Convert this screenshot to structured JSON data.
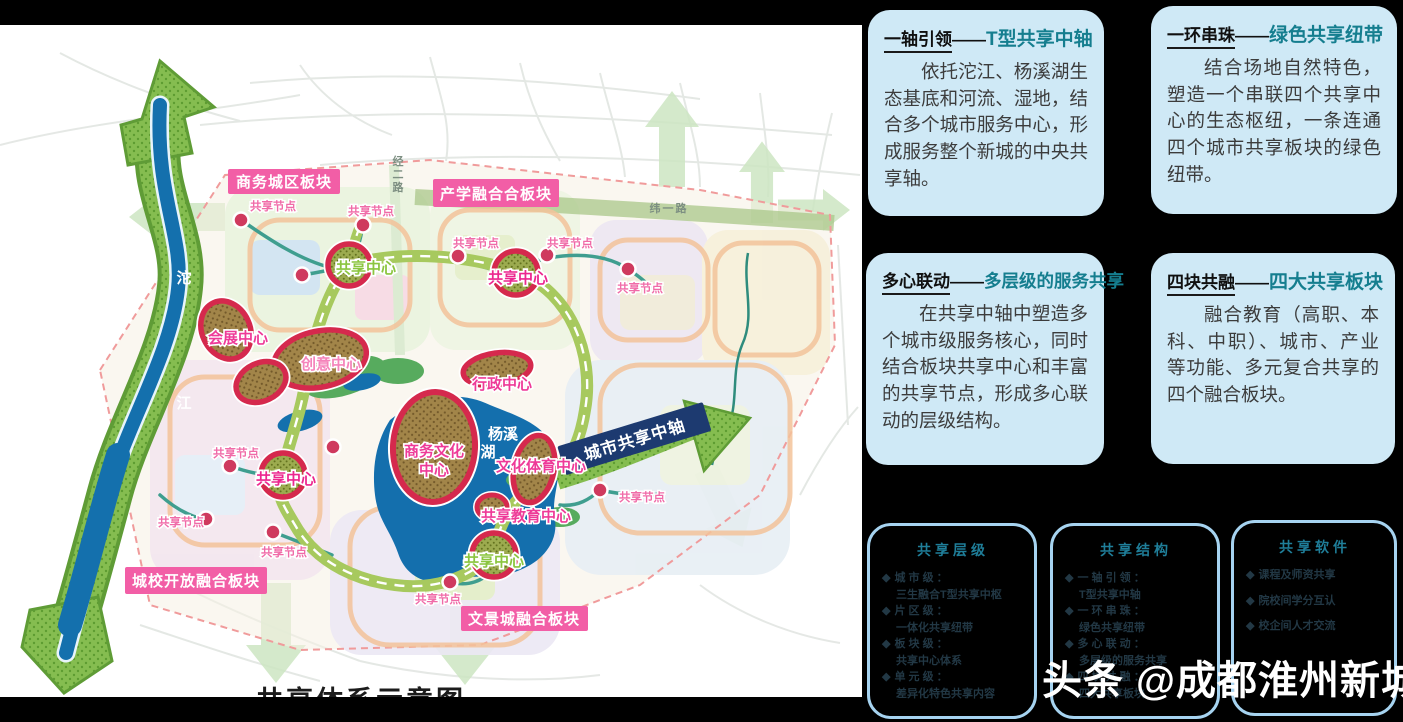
{
  "map": {
    "caption": "共享体系示意图",
    "river_label_top": "沱",
    "river_label_bottom": "江",
    "lake_label_line1": "杨溪",
    "lake_label_line2": "湖",
    "road_vertical": "经二路",
    "road_horizontal": "纬一路",
    "axis_label": "城市共享中轴",
    "node_label": "共享节点",
    "center_label": "共享中心",
    "blocks": {
      "business": "商务城区板块",
      "industry_edu": "产学融合合板块",
      "city_campus": "城校开放融合板块",
      "wenjing": "文景城融合板块"
    },
    "centers": {
      "exhibition": "会展中心",
      "creative": "创意中心",
      "admin": "行政中心",
      "biz_culture_line1": "商务文化",
      "biz_culture_line2": "中心",
      "culture_sports": "文化体育中心",
      "edu_share": "共享教育中心"
    }
  },
  "cards": [
    {
      "title_black": "一轴引领",
      "dash": "——",
      "title_teal": "T型共享中轴",
      "body": "依托沱江、杨溪湖生态基底和河流、湿地，结合多个城市服务中心，形成服务整个新城的中央共享轴。"
    },
    {
      "title_black": "一环串珠",
      "dash": "——",
      "title_teal": "绿色共享纽带",
      "body": "结合场地自然特色，塑造一个串联四个共享中心的生态枢纽，一条连通四个城市共享板块的绿色纽带。"
    },
    {
      "title_black": "多心联动",
      "dash": "——",
      "title_teal": "多层级的服务共享",
      "body": "在共享中轴中塑造多个城市级服务核心，同时结合板块共享中心和丰富的共享节点，形成多心联动的层级结构。"
    },
    {
      "title_black": "四块共融",
      "dash": "——",
      "title_teal": "四大共享板块",
      "body": "融合教育（高职、本科、中职）、城市、产业等功能、多元复合共享的四个融合板块。"
    }
  ],
  "bullet": "◆",
  "mini_cards": [
    {
      "title": "共享层级",
      "items": [
        {
          "label": "城 市 级 ：",
          "value": "三生融合T型共享中枢"
        },
        {
          "label": "片 区 级 ：",
          "value": "一体化共享纽带"
        },
        {
          "label": "板 块 级 ：",
          "value": "共享中心体系"
        },
        {
          "label": "单 元 级 ：",
          "value": "差异化特色共享内容"
        }
      ]
    },
    {
      "title": "共享结构",
      "items": [
        {
          "label": "一 轴 引 领 ：",
          "value": "T型共享中轴"
        },
        {
          "label": "一 环 串 珠 ：",
          "value": "绿色共享纽带"
        },
        {
          "label": "多 心 联 动 ：",
          "value": "多层级的服务共享"
        },
        {
          "label": "四 块 共 融 ：",
          "value": "四大共享板块"
        }
      ]
    },
    {
      "title": "共享软件",
      "items": [
        {
          "label": "课程及师资共享",
          "value": ""
        },
        {
          "label": "院校间学分互认",
          "value": ""
        },
        {
          "label": "校企间人才交流",
          "value": ""
        }
      ]
    }
  ],
  "watermark": {
    "brand": "头条",
    "handle": "@成都淮州新城"
  },
  "colors": {
    "accent_pink": "#f25ea6",
    "accent_teal": "#157e8f",
    "card_bg": "#cfe9f6",
    "mini_border": "#a6d3f0",
    "magenta_label": "#ec268f",
    "green_label": "#8bc53f",
    "water_blue": "#1470ad",
    "ring_road_olive": "#a7c95e",
    "arrow_green": "#7cb74b"
  }
}
